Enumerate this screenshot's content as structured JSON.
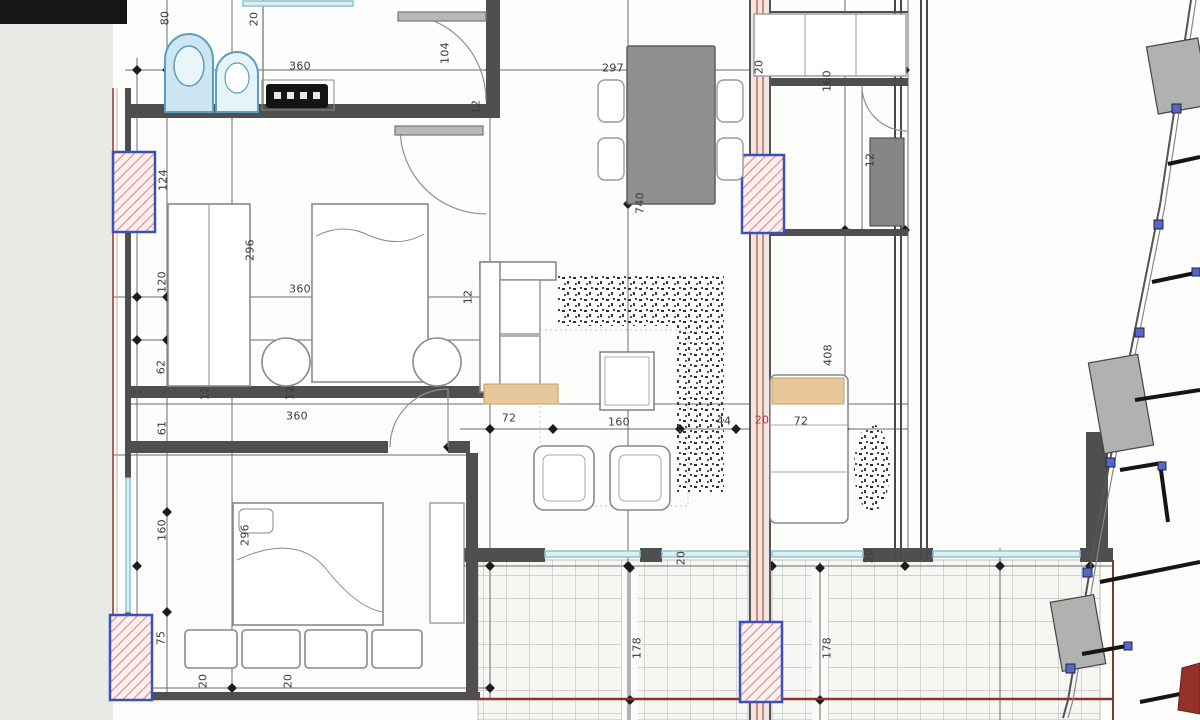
{
  "drawing": {
    "kind": "apartment floor plan with terrace and site key plan",
    "palette": {
      "wall_gray": "#4f4f4f",
      "section_red": "#a84b42",
      "column_outline_blue": "#3a50c0",
      "column_hatch_pink": "#e09090",
      "fixture_blue": "#5a9fc0",
      "window_teal": "#8fc3cf",
      "furniture_gray": "#8c8c8c",
      "seat_tan": "#e8c89a",
      "tile_line": "#c6c6c2",
      "dim_text": "#3b3b3b"
    }
  },
  "plan": {
    "dimension_labels": [
      {
        "text": "80",
        "x": 165,
        "y": 18,
        "rot": -90
      },
      {
        "text": "20",
        "x": 254,
        "y": 19,
        "rot": -90
      },
      {
        "text": "360",
        "x": 300,
        "y": 66,
        "rot": 0
      },
      {
        "text": "104",
        "x": 445,
        "y": 53,
        "rot": -90
      },
      {
        "text": "12",
        "x": 476,
        "y": 107,
        "rot": -90
      },
      {
        "text": "297",
        "x": 613,
        "y": 68,
        "rot": 0
      },
      {
        "text": "20",
        "x": 759,
        "y": 67,
        "rot": -90
      },
      {
        "text": "160",
        "x": 827,
        "y": 81,
        "rot": -90
      },
      {
        "text": "12",
        "x": 870,
        "y": 160,
        "rot": -90
      },
      {
        "text": "740",
        "x": 640,
        "y": 203,
        "rot": -90
      },
      {
        "text": "124",
        "x": 163,
        "y": 180,
        "rot": -90
      },
      {
        "text": "296",
        "x": 250,
        "y": 250,
        "rot": -90
      },
      {
        "text": "12",
        "x": 468,
        "y": 297,
        "rot": -90
      },
      {
        "text": "120",
        "x": 162,
        "y": 282,
        "rot": -90
      },
      {
        "text": "360",
        "x": 300,
        "y": 289,
        "rot": 0
      },
      {
        "text": "62",
        "x": 161,
        "y": 367,
        "rot": -90
      },
      {
        "text": "12",
        "x": 205,
        "y": 393,
        "rot": -90
      },
      {
        "text": "12",
        "x": 290,
        "y": 393,
        "rot": -90
      },
      {
        "text": "360",
        "x": 297,
        "y": 416,
        "rot": 0
      },
      {
        "text": "61",
        "x": 162,
        "y": 428,
        "rot": -90
      },
      {
        "text": "72",
        "x": 509,
        "y": 418,
        "rot": 0
      },
      {
        "text": "160",
        "x": 619,
        "y": 422,
        "rot": 0
      },
      {
        "text": "44",
        "x": 724,
        "y": 421,
        "rot": 0
      },
      {
        "text": "20",
        "x": 762,
        "y": 420,
        "rot": 0,
        "color": "#a04038"
      },
      {
        "text": "72",
        "x": 801,
        "y": 421,
        "rot": 0
      },
      {
        "text": "408",
        "x": 828,
        "y": 355,
        "rot": -90
      },
      {
        "text": "160",
        "x": 162,
        "y": 530,
        "rot": -90
      },
      {
        "text": "296",
        "x": 245,
        "y": 535,
        "rot": -90
      },
      {
        "text": "75",
        "x": 161,
        "y": 638,
        "rot": -90
      },
      {
        "text": "20",
        "x": 203,
        "y": 681,
        "rot": -90
      },
      {
        "text": "20",
        "x": 288,
        "y": 681,
        "rot": -90
      },
      {
        "text": "20",
        "x": 681,
        "y": 558,
        "rot": -90
      },
      {
        "text": "20",
        "x": 869,
        "y": 556,
        "rot": -90
      },
      {
        "text": "178",
        "x": 637,
        "y": 648,
        "rot": -90
      },
      {
        "text": "178",
        "x": 827,
        "y": 648,
        "rot": -90
      }
    ]
  }
}
